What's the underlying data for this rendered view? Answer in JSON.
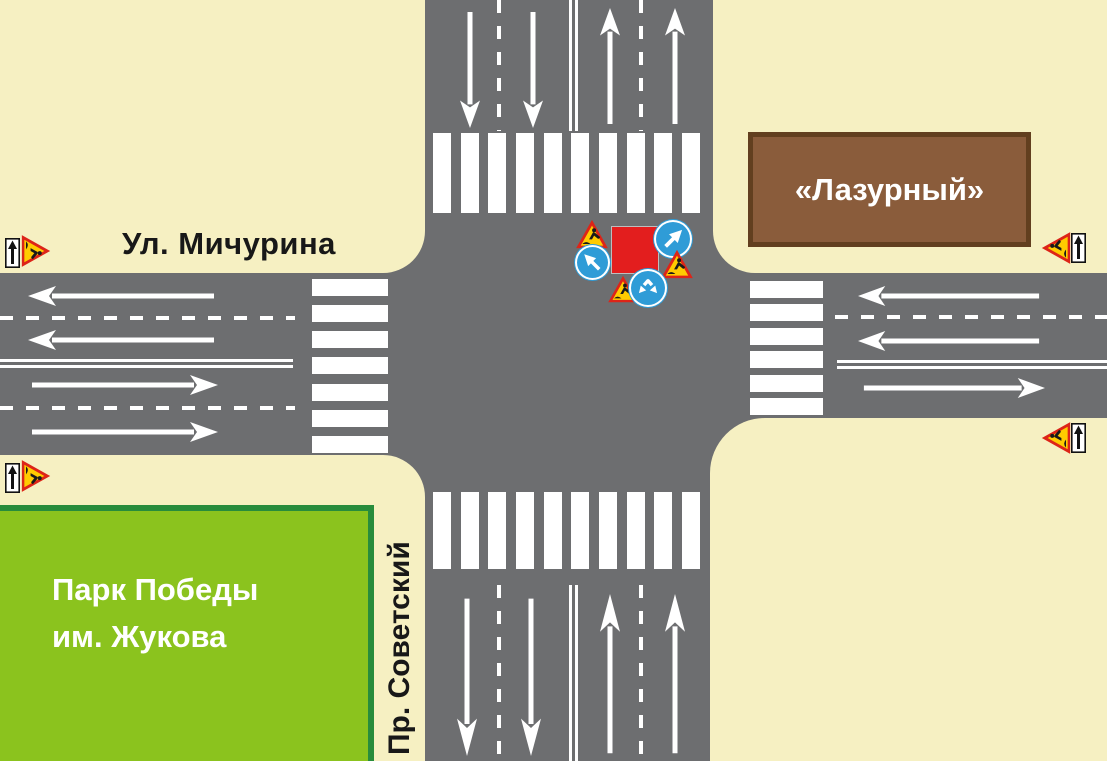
{
  "streets": {
    "michurina": "Ул. Мичурина",
    "sovetsky": "Пр. Советский"
  },
  "places": {
    "building": "«Лазурный»",
    "park_line1": "Парк Победы",
    "park_line2": "им. Жукова"
  },
  "signs": {
    "closure_square": "road-closed-red-square",
    "center_cluster": [
      "roadworks-triangle",
      "detour-arrow-up-right",
      "detour-arrow-up-left",
      "roadworks-triangle",
      "roadworks-triangle",
      "pass-either-side-arrows"
    ],
    "corner_top_left": [
      "one-way-straight",
      "roadworks-triangle"
    ],
    "corner_bottom_left": [
      "one-way-straight",
      "roadworks-triangle"
    ],
    "corner_top_right": [
      "roadworks-triangle",
      "one-way-straight"
    ],
    "corner_right_middle": [
      "roadworks-triangle",
      "one-way-straight"
    ]
  },
  "colors": {
    "background": "#F6F0C2",
    "road": "#6D6E70",
    "marking": "#FFFFFF",
    "park_fill": "#8BC31E",
    "park_border": "#288C3C",
    "building_fill": "#8A5C3B",
    "building_border": "#623F1F",
    "closure_red": "#E31E1E",
    "sign_triangle_red": "#DD2418",
    "sign_triangle_yellow": "#FFCB00",
    "sign_blue": "#2F9CD7"
  }
}
